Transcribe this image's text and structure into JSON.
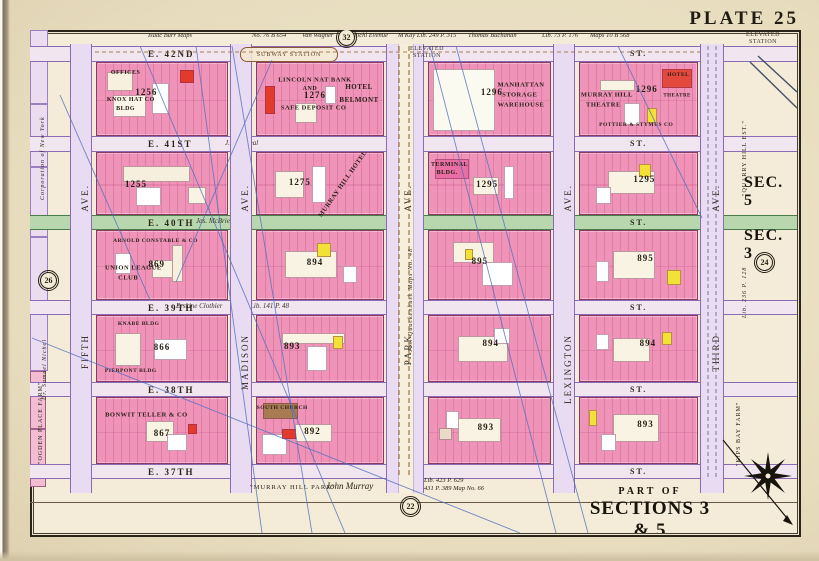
{
  "plate": {
    "title": "PLATE 25",
    "part_of": "PART OF",
    "sections": "SECTIONS 3 & 5",
    "scale_note": "Scale 80 Feet to an Inch"
  },
  "section_labels": {
    "upper": "SEC. 5",
    "lower": "SEC. 3"
  },
  "reference_circles": [
    {
      "n": "32"
    },
    {
      "n": "26"
    },
    {
      "n": "24"
    },
    {
      "n": "22"
    }
  ],
  "top_annotations": [
    "Isaac Burr Maps",
    "No. 76 B 654",
    "Van Wagner",
    "Michl Evenue",
    "M'Kay Lib. 249 P. 315",
    "Thomas Buchanan",
    "Lib. 73 P. 176",
    "Maps 10 B 568"
  ],
  "stations": {
    "subway": "SUBWAY STATION",
    "elevated_a": "ELEVATED STATION",
    "elevated_b": "ELEVATED STATION"
  },
  "left_margin": [
    "Corporation of New York",
    "Dr. Samuel Nichol",
    "\"OGDEN PLACE FARM\""
  ],
  "right_margin": [
    "\"QUARRY HILL EST.\"",
    "Lib. 236 P. 128",
    "\"KIPS BAY FARM\""
  ],
  "bottom_margin": {
    "park_quote": "\"MURRAY HILL PARK\"",
    "owner": "John Murray",
    "deed_line1": "Lib. 423 P. 629",
    "deed_line2": "431 P. 389   Map No. 66"
  },
  "street_annotations": {
    "e41": "J. & J. Peal",
    "e40": "Jas. McBrien",
    "e39_script": "Erskine Clothier",
    "e39_deed": "Lib. 141 P. 48",
    "park_ave_note": "Jas. Quackenbush Maps No. 48"
  },
  "streets": [
    {
      "label": "E. 42ND",
      "suffix": "ST."
    },
    {
      "label": "E. 41ST",
      "suffix": "ST."
    },
    {
      "label": "E. 40TH",
      "suffix": "ST."
    },
    {
      "label": "E. 39TH",
      "suffix": "ST."
    },
    {
      "label": "E. 38TH",
      "suffix": "ST."
    },
    {
      "label": "E. 37TH",
      "suffix": "ST."
    }
  ],
  "avenues": [
    {
      "name": "FIFTH",
      "ave": "AVE."
    },
    {
      "name": "MADISON",
      "ave": "AVE."
    },
    {
      "name": "PARK",
      "ave": "AVE."
    },
    {
      "name": "LEXINGTON",
      "ave": "AVE."
    },
    {
      "name": "THIRD",
      "ave": "AVE."
    }
  ],
  "blocks": [
    {
      "number": "1256",
      "num": [
        38,
        40
      ],
      "buildings": [
        {
          "t": "OFFICES",
          "x": 22,
          "y": 14,
          "s": 6
        },
        {
          "t": "KNOX HAT CO",
          "x": 26,
          "y": 52,
          "s": 6
        },
        {
          "t": "BLDG",
          "x": 22,
          "y": 64,
          "s": 6
        }
      ]
    },
    {
      "number": "1276",
      "num": [
        46,
        44
      ],
      "buildings": [
        {
          "t": "LINCOLN NAT BANK",
          "x": 46,
          "y": 24,
          "s": 6.5
        },
        {
          "t": "AND",
          "x": 42,
          "y": 36,
          "s": 6
        },
        {
          "t": "SAFE DEPOSIT CO",
          "x": 45,
          "y": 62,
          "s": 6.5
        },
        {
          "t": "HOTEL",
          "x": 81,
          "y": 34,
          "s": 7
        },
        {
          "t": "BELMONT",
          "x": 81,
          "y": 52,
          "s": 7
        }
      ]
    },
    {
      "number": "1296",
      "num": [
        52,
        40
      ],
      "buildings": [
        {
          "t": "MANHATTAN",
          "x": 76,
          "y": 30,
          "s": 6.5
        },
        {
          "t": "STORAGE",
          "x": 75,
          "y": 44,
          "s": 6.5
        },
        {
          "t": "WAREHOUSE",
          "x": 76,
          "y": 58,
          "s": 6.5
        }
      ]
    },
    {
      "number": "1296",
      "num": [
        57,
        36
      ],
      "buildings": [
        {
          "t": "MURRAY HILL",
          "x": 23,
          "y": 44,
          "s": 6.5
        },
        {
          "t": "THEATRE",
          "x": 20,
          "y": 58,
          "s": 6.5
        },
        {
          "t": "POTTIER & STYMUS CO",
          "x": 48,
          "y": 86,
          "s": 5.5
        },
        {
          "t": "HOTEL",
          "x": 84,
          "y": 16,
          "s": 5.5
        },
        {
          "t": "THEATRE",
          "x": 83,
          "y": 46,
          "s": 5
        }
      ]
    },
    {
      "number": "1255",
      "num": [
        30,
        50
      ],
      "buildings": []
    },
    {
      "number": "1275",
      "num": [
        34,
        48
      ],
      "buildings": [
        {
          "t": "MURRAY HILL HOTEL",
          "x": 68,
          "y": 50,
          "s": 6.5,
          "rot": -55
        }
      ]
    },
    {
      "number": "1295",
      "num": [
        48,
        50
      ],
      "buildings": [
        {
          "t": "TERMINAL",
          "x": 17,
          "y": 20,
          "s": 6
        },
        {
          "t": "BLDG.",
          "x": 15,
          "y": 33,
          "s": 6
        }
      ]
    },
    {
      "number": "1295",
      "num": [
        55,
        42
      ],
      "buildings": []
    },
    {
      "number": "869",
      "num": [
        46,
        48
      ],
      "buildings": [
        {
          "t": "ARNOLD CONSTABLE & CO",
          "x": 45,
          "y": 15,
          "s": 5.5
        },
        {
          "t": "UNION LEAGUE",
          "x": 28,
          "y": 55,
          "s": 6.5
        },
        {
          "t": "CLUB",
          "x": 24,
          "y": 69,
          "s": 6.5
        }
      ]
    },
    {
      "number": "894",
      "num": [
        46,
        46
      ],
      "buildings": []
    },
    {
      "number": "895",
      "num": [
        42,
        44
      ],
      "buildings": []
    },
    {
      "number": "895",
      "num": [
        56,
        40
      ],
      "buildings": []
    },
    {
      "number": "866",
      "num": [
        50,
        48
      ],
      "buildings": [
        {
          "t": "KNABE BLDG",
          "x": 32,
          "y": 12,
          "s": 5.5
        },
        {
          "t": "PIERPONT BLDG",
          "x": 26,
          "y": 85,
          "s": 5.5
        }
      ]
    },
    {
      "number": "893",
      "num": [
        28,
        46
      ],
      "buildings": []
    },
    {
      "number": "894",
      "num": [
        51,
        42
      ],
      "buildings": []
    },
    {
      "number": "894",
      "num": [
        58,
        42
      ],
      "buildings": []
    },
    {
      "number": "867",
      "num": [
        50,
        54
      ],
      "buildings": [
        {
          "t": "BONWIT TELLER & CO",
          "x": 38,
          "y": 26,
          "s": 6.5
        }
      ]
    },
    {
      "number": "892",
      "num": [
        44,
        50
      ],
      "buildings": [
        {
          "t": "SOUTH CHURCH",
          "x": 20,
          "y": 16,
          "s": 5.5
        }
      ]
    },
    {
      "number": "893",
      "num": [
        47,
        44
      ],
      "buildings": []
    },
    {
      "number": "893",
      "num": [
        56,
        40
      ],
      "buildings": []
    }
  ],
  "overlays": {
    "blue_lines": [
      [
        196,
        46,
        262,
        533
      ],
      [
        232,
        46,
        312,
        533
      ],
      [
        430,
        46,
        556,
        533
      ],
      [
        456,
        46,
        588,
        533
      ],
      [
        140,
        46,
        345,
        533
      ],
      [
        32,
        338,
        520,
        533
      ],
      [
        272,
        60,
        176,
        282
      ],
      [
        618,
        46,
        702,
        218
      ],
      [
        60,
        95,
        150,
        300
      ]
    ],
    "el_lines": [
      [
        750,
        62,
        797,
        108
      ],
      [
        758,
        56,
        797,
        92
      ]
    ]
  },
  "colors": {
    "paper": "#e9dfc3",
    "field": "#f4ecd8",
    "block_pink": "#f093b8",
    "deep_pink": "#e76fa3",
    "street_lavender": "#f1e6f0",
    "green_street": "#b9d7ae",
    "purple_line": "#8c6bb5",
    "red_lot": "#e23b2e",
    "yellow_lot": "#f2e235",
    "blue_line": "#4f6fc0",
    "rail_brown": "#96652f"
  }
}
